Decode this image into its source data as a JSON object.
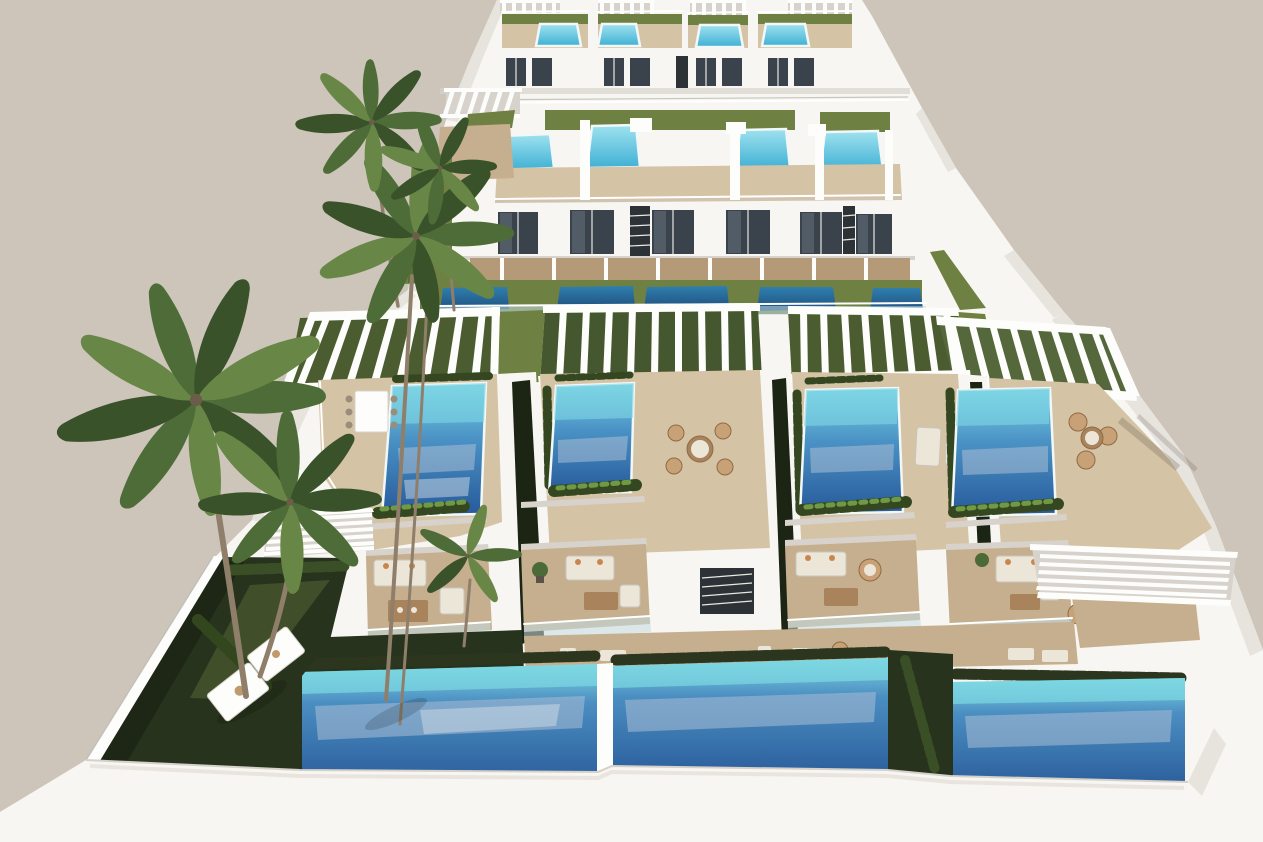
{
  "image": {
    "width": 1263,
    "height": 842,
    "kind": "3d-architectural-rendering",
    "view": "high-angle aerial"
  },
  "scene": {
    "description": "Aerial rendering of a modern terraced complex of white villas with rooftop swimming pools, wooden sun decks, pergolas, hedge planters, palm trees, private gardens, ground-level pools and a white perimeter wall under a plain beige sky.",
    "palette": {
      "background": "#cdc5ba",
      "building_white": "#f8f6f2",
      "building_shadow": "#d7d3cc",
      "glass_dark": "#3a424b",
      "deck_tan": "#d5c3a5",
      "deck_mid": "#c6af8e",
      "lawn_olive": "#6f8142",
      "garden_dark": "#28331d",
      "hedge_green": "#344721",
      "pool_aqua": "#7ad3e3",
      "pool_mid": "#4a92c5",
      "pool_deep": "#27599a",
      "pool_cyan_light": "#9fe2ef",
      "pool_cyan_deep": "#3fb0d4",
      "plunge_top": "#2f7fae",
      "plunge_deep": "#1f4f7e",
      "ground_aqua": "#7ed8e2",
      "ground_mid": "#4b8ec2",
      "ground_deep": "#2a5d9b",
      "water_reflection": "#a9bdd3",
      "palm_green": "#4e6c38",
      "palm_trunk": "#8f7f6a",
      "wood_furniture": "#a8835c",
      "cushion_cream": "#ece6d8",
      "accent_pillow": "#c9854e"
    },
    "complex": {
      "style": "modern white cubic villas, terraced toward viewer",
      "rows": [
        {
          "id": "far-row",
          "villas": 4,
          "rooftop_pools": 4,
          "pergolas": 4
        },
        {
          "id": "upper-row",
          "villas": 6,
          "rooftop_pools": 4,
          "plunge_pools": 5,
          "spiral_staircases": 2,
          "glass_facades": 6
        },
        {
          "id": "middle-row",
          "villas": 4,
          "terrace_pools": 4,
          "pergolas": 4,
          "dining_sets": 2,
          "lounge_chairs": 2
        },
        {
          "id": "near-row",
          "villas": 4,
          "balcony_lounges": 4,
          "ground_pools": 3,
          "sun_loungers": 2,
          "louvered_canopies": 2
        }
      ],
      "features": [
        "rooftop pools",
        "slatted pergolas",
        "glass balustrades",
        "spiral staircases",
        "timber sun decks",
        "hedge planters",
        "outdoor lounge furniture",
        "private lawns",
        "white perimeter wall"
      ]
    },
    "vegetation": {
      "palm_trees": 6,
      "hedge_planters": true,
      "lawns": true,
      "potted_plants": true
    }
  }
}
